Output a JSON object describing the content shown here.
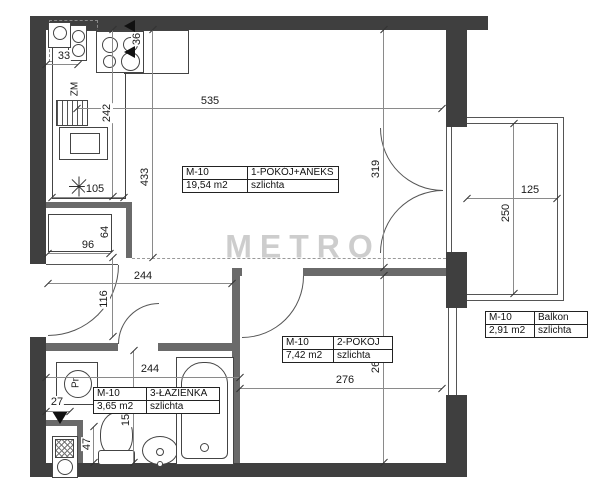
{
  "watermark": "METRO",
  "rooms": {
    "main": {
      "unit": "M-10",
      "name": "1-POKÓJ+ANEKS",
      "area": "19,54 m2",
      "floor": "szlichta"
    },
    "room2": {
      "unit": "M-10",
      "name": "2-POKÓJ",
      "area": "7,42 m2",
      "floor": "szlichta"
    },
    "bath": {
      "unit": "M-10",
      "name": "3-ŁAZIENKA",
      "area": "3,65 m2",
      "floor": "szlichta"
    },
    "balcony": {
      "unit": "M-10",
      "name": "Balkon",
      "area": "2,91 m2",
      "floor": "szlichta"
    }
  },
  "fixtures": {
    "dishwasher_label": "ZM",
    "washer_label": "Pr"
  },
  "dimensions": {
    "top_width": "535",
    "kitchen_run": "242",
    "main_left_height": "433",
    "counter_depth": "105",
    "corner_unit": "33",
    "sink_gap": "36",
    "wardrobe_width": "96",
    "wardrobe_depth": "64",
    "hall_width": "244",
    "hall_niche": "116",
    "bath_width": "244",
    "bath_height": "155",
    "shaft_width": "47",
    "shaft_offset": "27",
    "room2_width": "276",
    "room2_height": "268",
    "main_right_height": "319",
    "balcony_width": "125",
    "balcony_depth": "250"
  },
  "colors": {
    "outer_wall": "#3f3f3f",
    "partition": "#6a6a6a",
    "line": "#555",
    "dimension": "#8a8a8a",
    "watermark_gray": "#828282"
  }
}
